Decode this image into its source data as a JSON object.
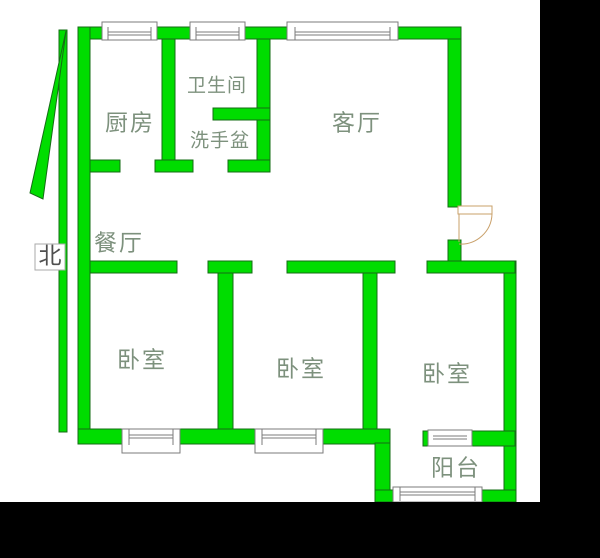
{
  "floorplan": {
    "type": "apartment-floor-plan",
    "rooms": {
      "kitchen": "厨房",
      "bathroom": "卫生间",
      "washbasin": "洗手盆",
      "living_room": "客厅",
      "dining_room": "餐厅",
      "bedroom_1": "卧室",
      "bedroom_2": "卧室",
      "bedroom_3": "卧室",
      "balcony": "阳台"
    },
    "north_label": "北",
    "icons": {
      "north-arrow-icon": "tall green triangle pennant with vertical staff pointing up",
      "entry-door-icon": "quarter-circle door swing arc on right wall",
      "window-icon": "double-line window symbol in wall"
    }
  },
  "colors": {
    "wall_fill": "#00dd00",
    "wall_outline": "#166c16",
    "window_frame": "#7b7b7b",
    "door_swing": "#c9a06a",
    "room_label": "#7d917d",
    "north_text": "#4f4f4f",
    "plan_background": "#ffffff",
    "page_background": "#000000"
  }
}
